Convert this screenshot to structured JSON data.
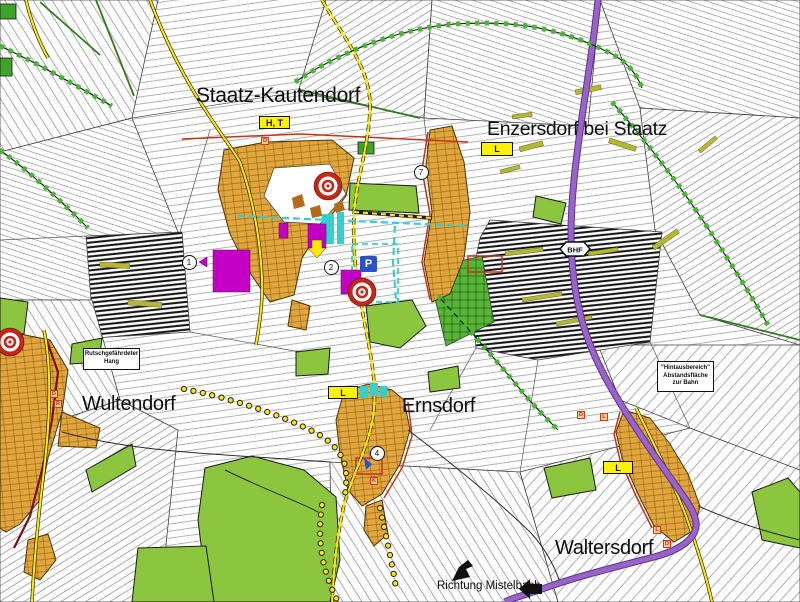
{
  "places": {
    "staatz": {
      "label": "Staatz-Kautendorf"
    },
    "enzersdorf": {
      "label": "Enzersdorf bei Staatz"
    },
    "wultendorf": {
      "label": "Wultendorf"
    },
    "ernsdorf": {
      "label": "Ernsdorf"
    },
    "waltersdorf": {
      "label": "Waltersdorf"
    }
  },
  "direction_note": {
    "label": "Richtung Mistelbach"
  },
  "zone_markers": {
    "ht": {
      "label": "H, T"
    },
    "l_enzersdorf": {
      "label": "L"
    },
    "l_ernsdorf": {
      "label": "L"
    },
    "l_waltersdorf": {
      "label": "L"
    },
    "parking": {
      "label": "P"
    },
    "station": {
      "label": "BHF"
    }
  },
  "annotations": {
    "landslide": {
      "line1": "Rutschgefährdeter",
      "line2": "Hang"
    },
    "rail_buffer": {
      "line1": "\"Hintausbereich\"",
      "line2": "Abstandsfläche",
      "line3": "zur Bahn"
    }
  },
  "circle_markers": [
    {
      "label": "1",
      "x": 189,
      "y": 262
    },
    {
      "label": "2",
      "x": 331,
      "y": 267
    },
    {
      "label": "7",
      "x": 421,
      "y": 172
    },
    {
      "label": "4",
      "x": 377,
      "y": 453
    }
  ],
  "letter_markers": [
    {
      "label": "D",
      "x": 261,
      "y": 137
    },
    {
      "label": "D",
      "x": 50,
      "y": 390
    },
    {
      "label": "R",
      "x": 54,
      "y": 400
    },
    {
      "label": "K",
      "x": 370,
      "y": 477
    },
    {
      "label": "L",
      "x": 653,
      "y": 526
    },
    {
      "label": "D",
      "x": 663,
      "y": 540
    },
    {
      "label": "D",
      "x": 577,
      "y": 411
    },
    {
      "label": "L",
      "x": 600,
      "y": 413
    }
  ],
  "colors": {
    "village_orange": "#E2A63C",
    "green": "#8CC63F",
    "railway_purple": "#9A63C8",
    "road_yellow": "#FFE800",
    "magenta": "#C400C4",
    "cyan": "#35CFCF",
    "boundary_red": "#C93018",
    "symbol_box_yellow": "#FFF200"
  }
}
